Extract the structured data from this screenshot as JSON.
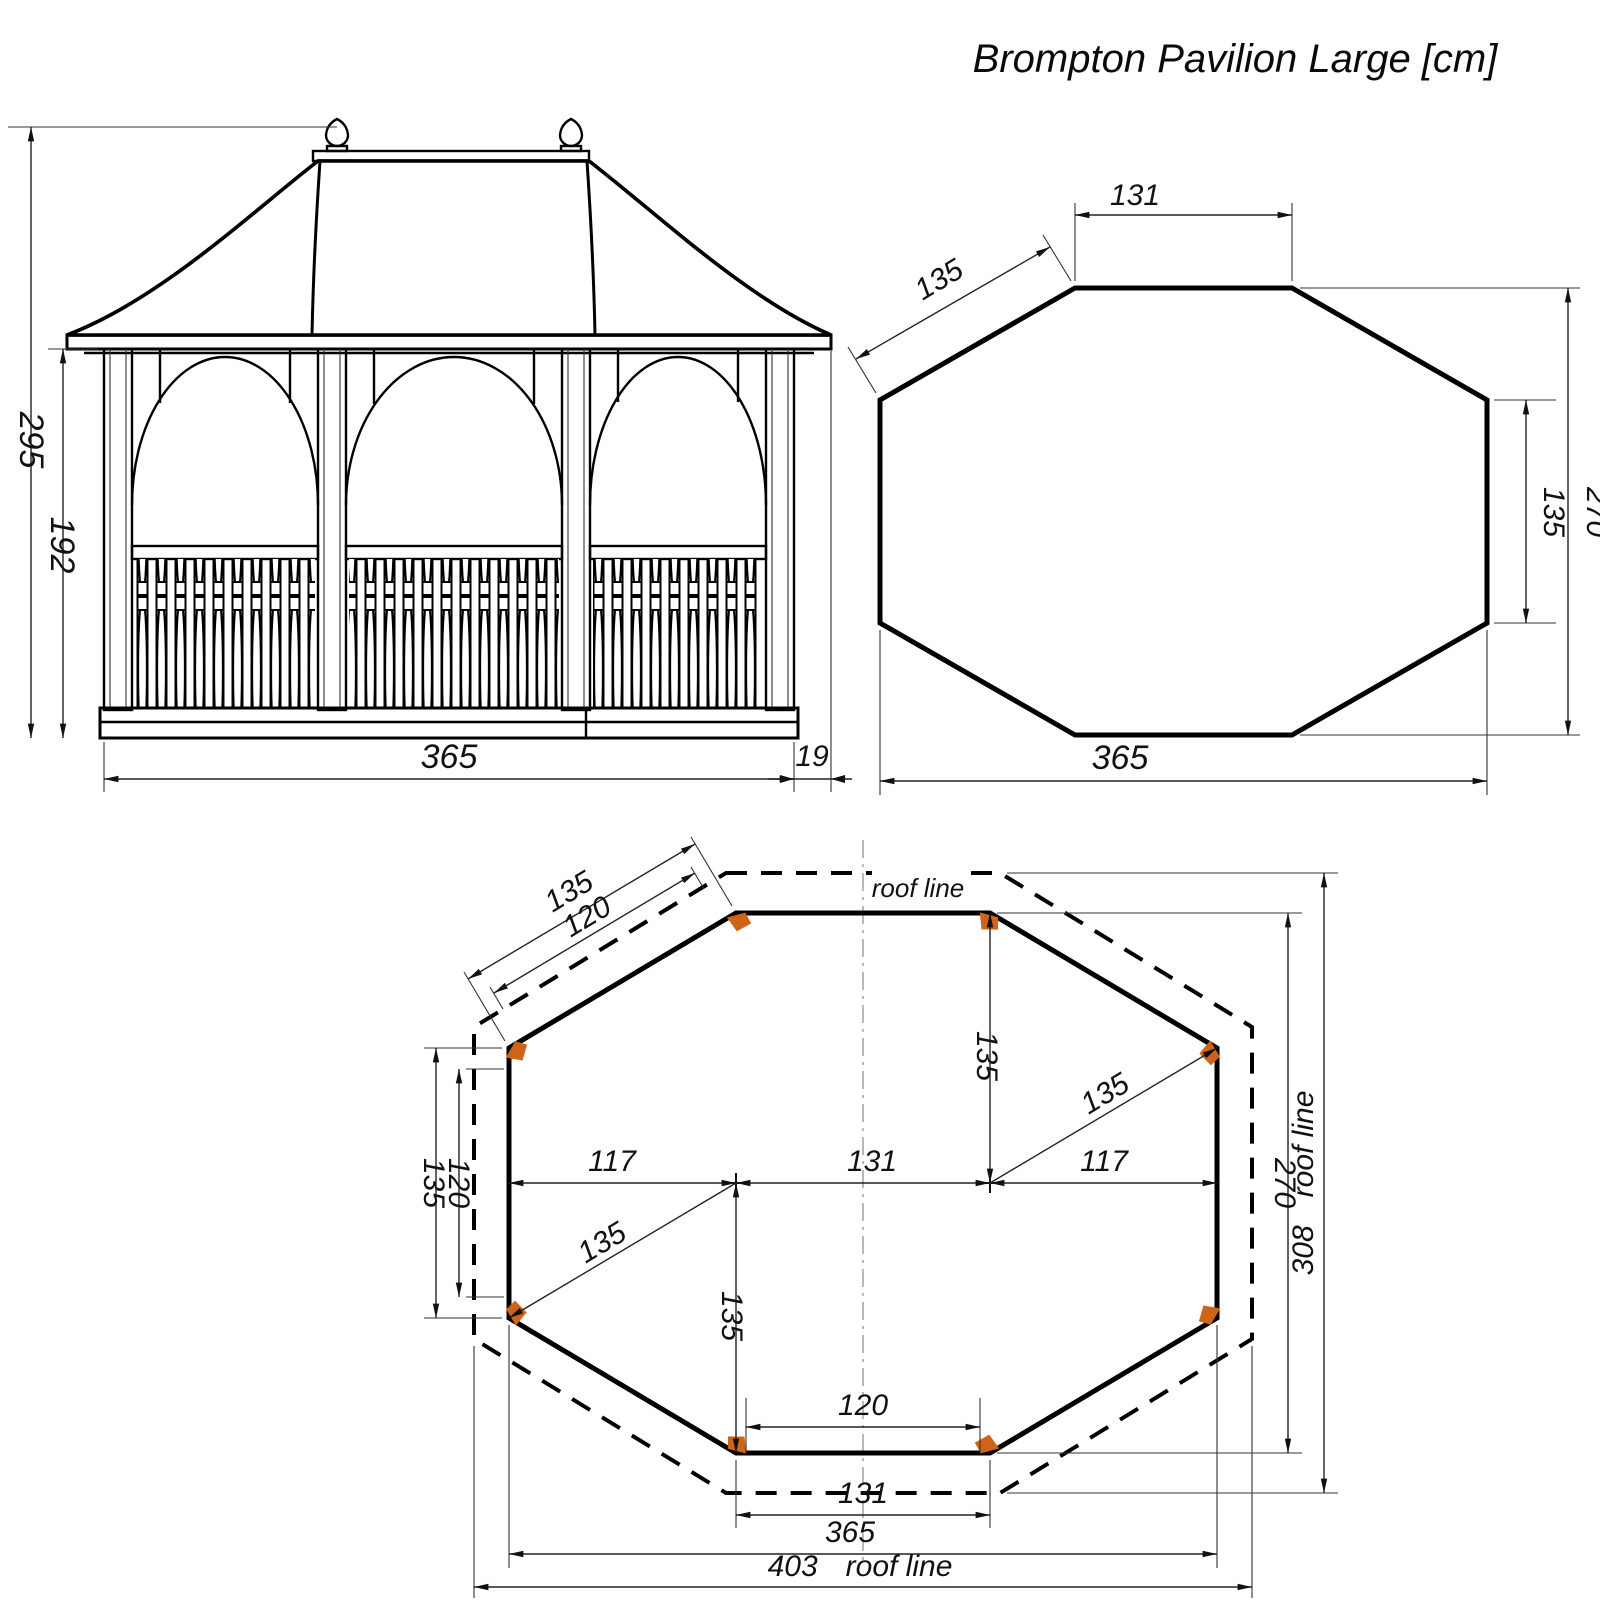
{
  "title": "Brompton Pavilion Large [cm]",
  "elevation": {
    "total_height": "295",
    "eaves_height": "192",
    "width": "365",
    "roof_overhang": "19"
  },
  "roof_plan": {
    "front_edge": "131",
    "diagonal_edge": "135",
    "side_edge": "135",
    "depth": "270",
    "width": "365"
  },
  "floor_plan": {
    "roof_line_label": "roof line",
    "diag_edge": "135",
    "diag_clear": "120",
    "side_edge": "135",
    "side_clear": "120",
    "left_run": "117",
    "center_span": "131",
    "right_run": "117",
    "rise_to_front": "135",
    "drop_to_back": "135",
    "diag_to_right_post": "135",
    "diag_to_left_post": "135",
    "front_clear": "120",
    "front_edge": "131",
    "width": "365",
    "roof_width": "403",
    "roof_width_label": "roof line",
    "depth": "270",
    "roof_depth": "308",
    "roof_depth_label": "roof line"
  },
  "colors": {
    "post_marker": "#cf6317"
  }
}
